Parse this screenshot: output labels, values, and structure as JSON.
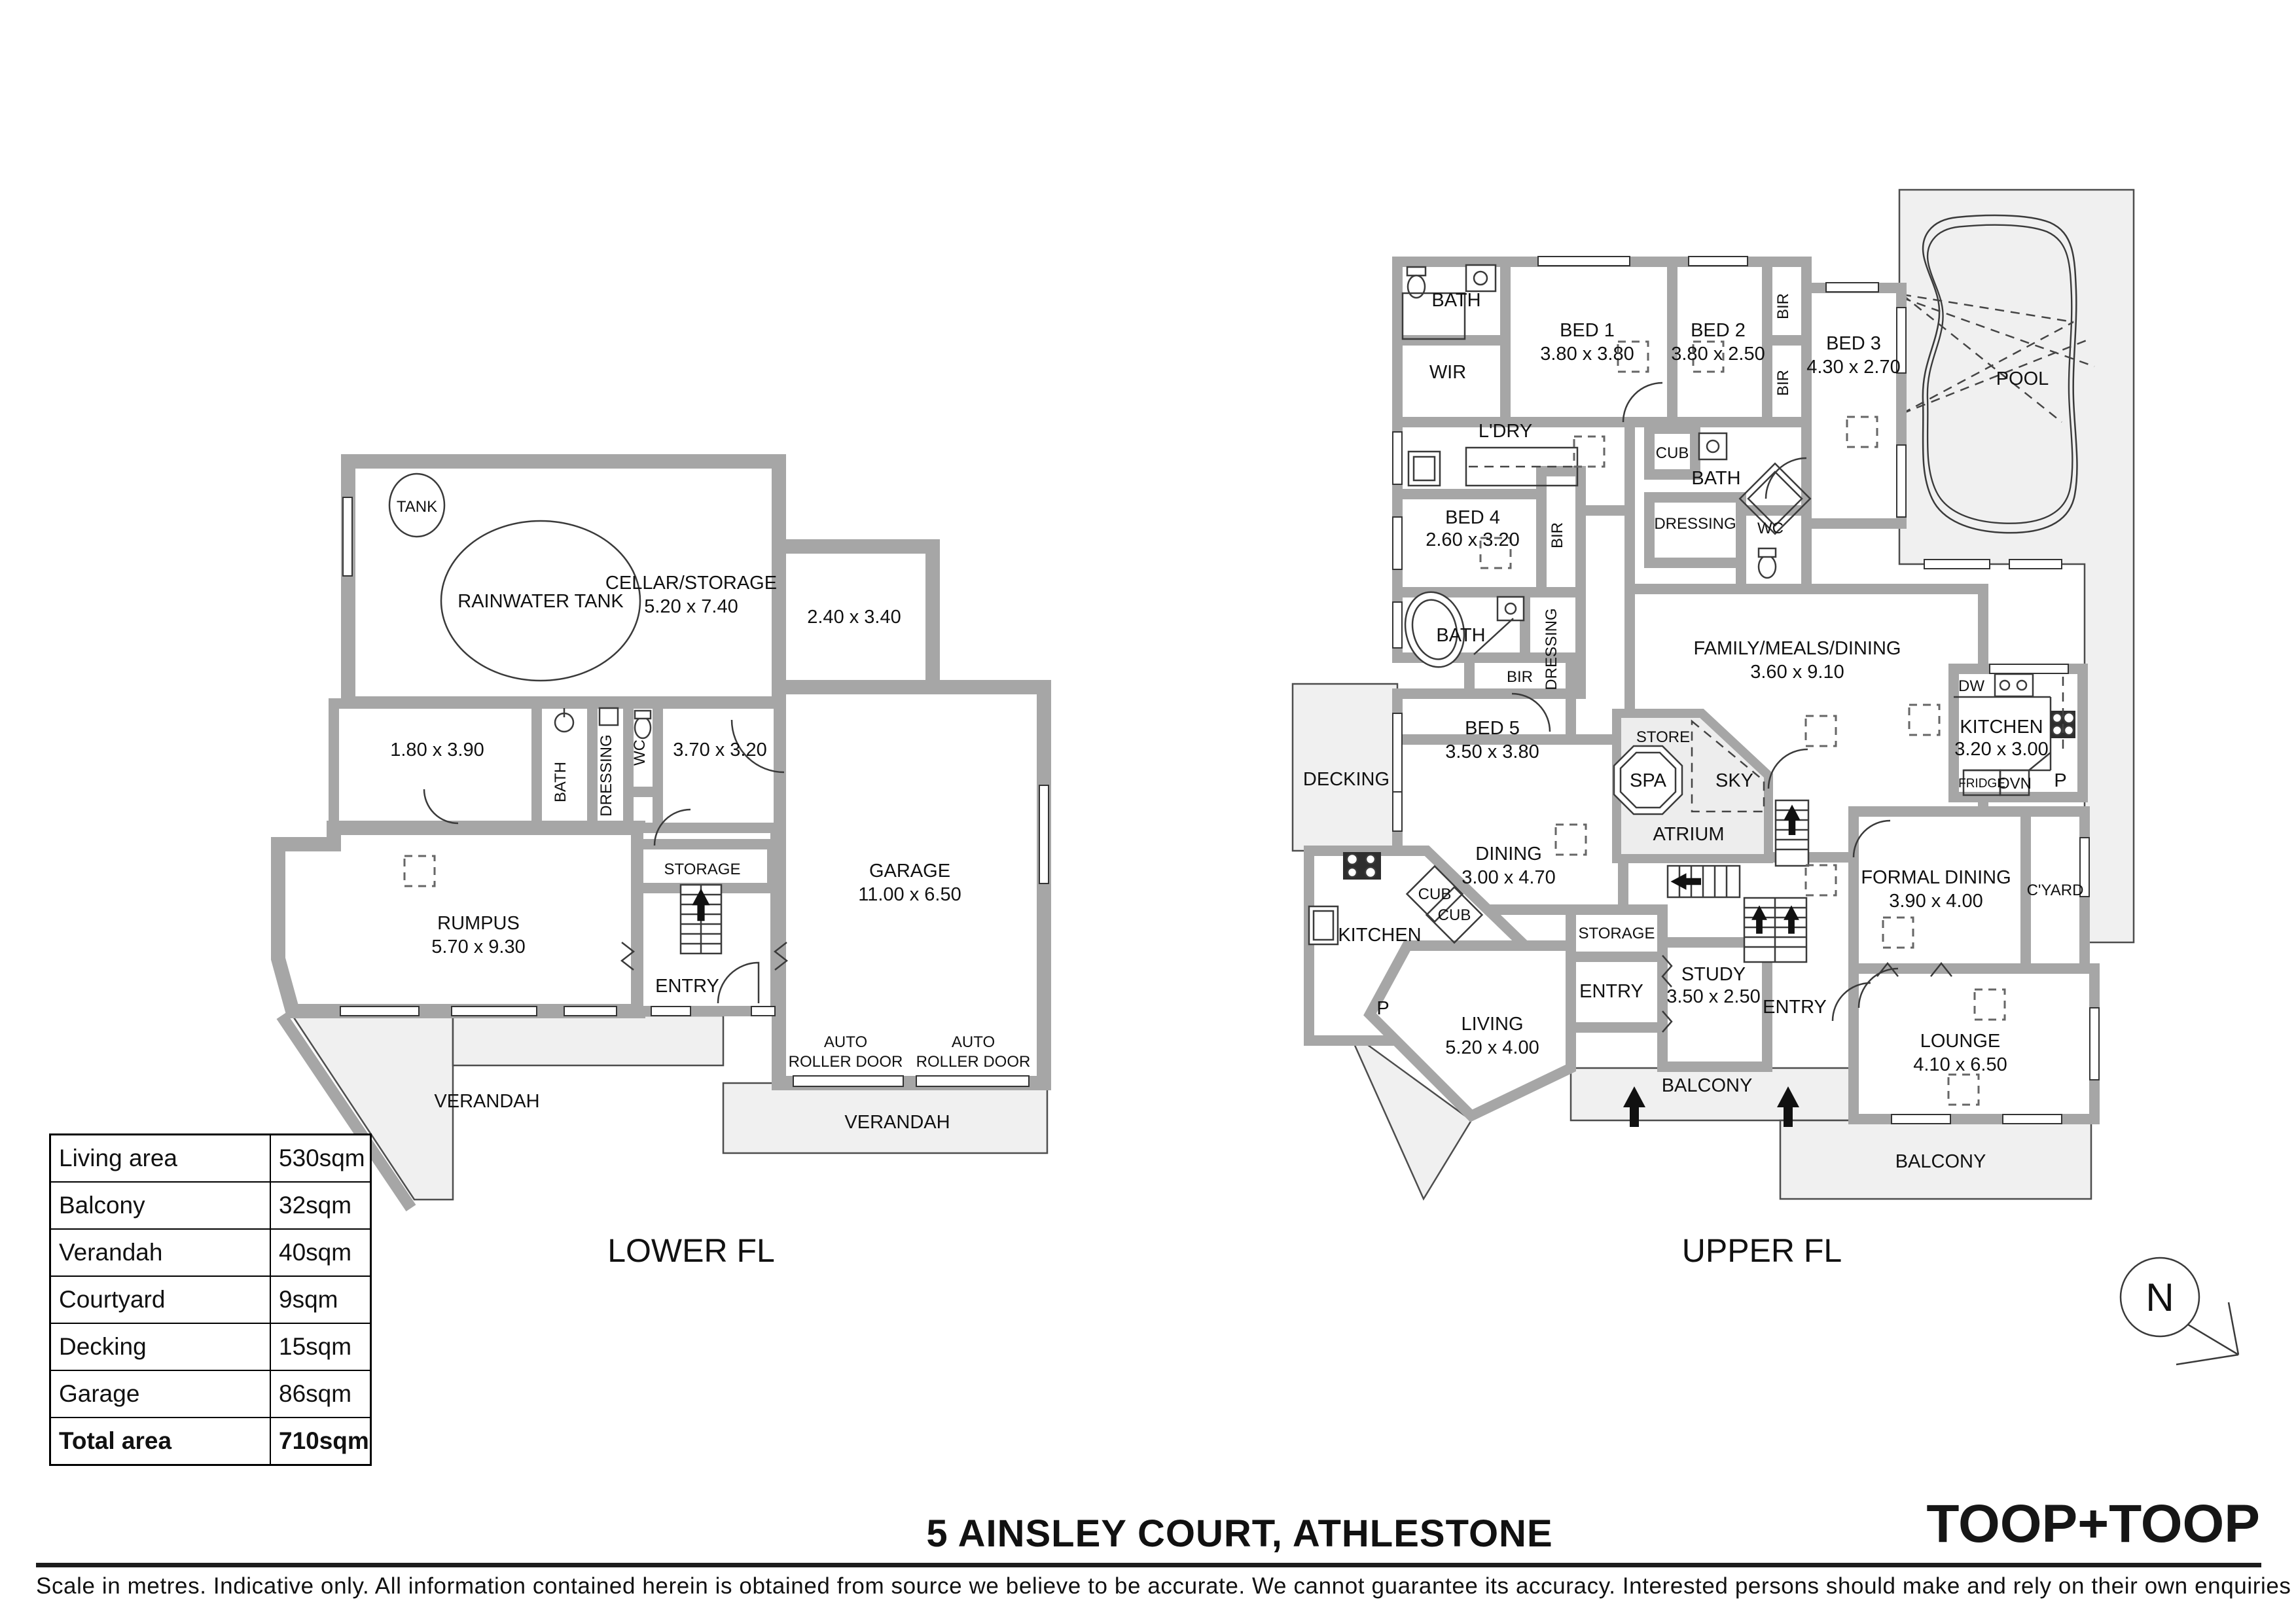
{
  "meta": {
    "address": "5 AINSLEY COURT, ATHLESTONE",
    "disclaimer": "Scale in metres. Indicative only. All information contained herein is obtained from source we believe to be accurate. We cannot guarantee its accuracy. Interested persons should make and rely on their own enquiries",
    "brand": "TOOP+TOOP",
    "north": "N"
  },
  "colors": {
    "wall": "#a6a6a6",
    "outdoor": "#f0f0f0",
    "line": "#3a3a3a",
    "text": "#111111"
  },
  "area_table": {
    "rows": [
      {
        "label": "Living area",
        "value": "530sqm"
      },
      {
        "label": "Balcony",
        "value": "32sqm"
      },
      {
        "label": "Verandah",
        "value": "40sqm"
      },
      {
        "label": "Courtyard",
        "value": "9sqm"
      },
      {
        "label": "Decking",
        "value": "15sqm"
      },
      {
        "label": "Garage",
        "value": "86sqm"
      },
      {
        "label": "Total area",
        "value": "710sqm"
      }
    ]
  },
  "lower": {
    "title": "LOWER FL",
    "tank": "TANK",
    "rainwater": "RAINWATER TANK",
    "cellar": {
      "name": "CELLAR/STORAGE",
      "dims": "5.20 x 7.40"
    },
    "room_240": "2.40 x 3.40",
    "room_180": "1.80 x 3.90",
    "bath": "BATH",
    "dressing": "DRESSING",
    "wc": "WC",
    "room_370": "3.70 x 3.20",
    "storage": "STORAGE",
    "garage": {
      "name": "GARAGE",
      "dims": "11.00 x 6.50"
    },
    "rumpus": {
      "name": "RUMPUS",
      "dims": "5.70 x 9.30"
    },
    "entry": "ENTRY",
    "roller1": {
      "line1": "AUTO",
      "line2": "ROLLER DOOR"
    },
    "roller2": {
      "line1": "AUTO",
      "line2": "ROLLER DOOR"
    },
    "verandah_left": "VERANDAH",
    "verandah_right": "VERANDAH"
  },
  "upper": {
    "title": "UPPER FL",
    "bath_tl": "BATH",
    "wir": "WIR",
    "bed1": {
      "name": "BED 1",
      "dims": "3.80 x 3.80"
    },
    "bed2": {
      "name": "BED 2",
      "dims": "3.80 x 2.50"
    },
    "bir_a": "BIR",
    "bir_b": "BIR",
    "bed3": {
      "name": "BED 3",
      "dims": "4.30 x 2.70"
    },
    "pool": "POOL",
    "ldry": "L'DRY",
    "cub_mid": "CUB",
    "bath_mid": "BATH",
    "bir_c": "BIR",
    "bed4": {
      "name": "BED 4",
      "dims": "2.60 x 3.20"
    },
    "dressing_mid": "DRESSING",
    "wc_mid": "WC",
    "bath_ll": "BATH",
    "dressing_ll": "DRESSING",
    "bir_d": "BIR",
    "bed5": {
      "name": "BED 5",
      "dims": "3.50 x 3.80"
    },
    "decking": "DECKING",
    "family": {
      "name": "FAMILY/MEALS/DINING",
      "dims": "3.60 x 9.10"
    },
    "dw": "DW",
    "kitchen_right": {
      "name": "KITCHEN",
      "dims": "3.20 x 3.00"
    },
    "store": "STORE",
    "spa": "SPA",
    "sky": "SKY",
    "atrium": "ATRIUM",
    "fridge": "FRIDGE",
    "ovn": "OVN",
    "pantry_right": "P",
    "dining": {
      "name": "DINING",
      "dims": "3.00 x 4.70"
    },
    "formal_dining": {
      "name": "FORMAL DINING",
      "dims": "3.90 x 4.00"
    },
    "cyard": "C'YARD",
    "cub1": "CUB",
    "cub2": "CUB",
    "kitchen_left": "KITCHEN",
    "pantry_left": "P",
    "storage": "STORAGE",
    "study": {
      "name": "STUDY",
      "dims": "3.50 x 2.50"
    },
    "entry_left": "ENTRY",
    "entry_right": "ENTRY",
    "living": {
      "name": "LIVING",
      "dims": "5.20 x 4.00"
    },
    "balcony_mid": "BALCONY",
    "lounge": {
      "name": "LOUNGE",
      "dims": "4.10 x 6.50"
    },
    "balcony_bottom": "BALCONY"
  }
}
